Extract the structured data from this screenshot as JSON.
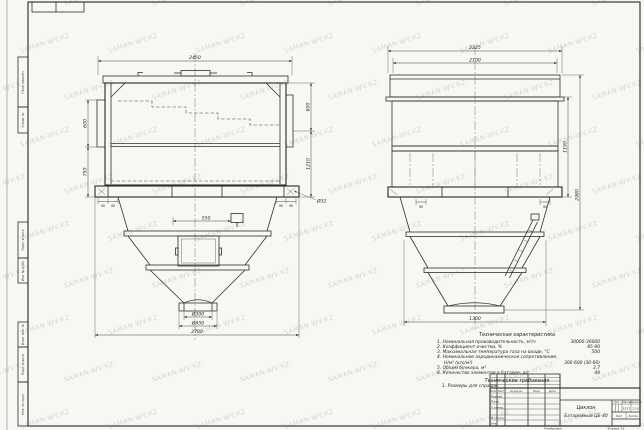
{
  "sheet": {
    "watermark": "SAMAN-WV.KZ"
  },
  "front_view": {
    "dims": {
      "width_top": "2450",
      "left_upper": "600",
      "left_lower": "750",
      "right_upper": "600",
      "right_lower": "1210",
      "inset": "550",
      "foot": "90",
      "hole": "Ø32",
      "outlet_inner": "Ø300",
      "outlet_outer": "Ø450",
      "width_bottom": "2700"
    }
  },
  "side_view": {
    "dims": {
      "width_top": "2225",
      "width_inner": "2100",
      "height_mid": "1190",
      "height_overall": "2980",
      "width_bottom": "1300",
      "foot": "90"
    }
  },
  "specs": {
    "title": "Техническая характеристика",
    "items": [
      {
        "label": "1. Номинальная производительность, м³/ч",
        "value": "30000-36000"
      },
      {
        "label": "2. Коэффициент очистки, %",
        "value": "85-90"
      },
      {
        "label": "3. Максимальная температура газа на входе, °С",
        "value": "500"
      },
      {
        "label": "4. Номинальное аэродинамическое сопротивление,",
        "value": ""
      },
      {
        "label": "Н/м² (кгс/м²)",
        "value": "300-600 (30-60)"
      },
      {
        "label": "5. Объем бункера, м³",
        "value": "3,7"
      },
      {
        "label": "6. Количество элементов в батарее, шт.",
        "value": "48"
      }
    ],
    "req_title": "Технические требования",
    "req_items": [
      "1. Размеры для справок."
    ]
  },
  "title_block": {
    "header_cols": [
      "Изм.",
      "Лист",
      "№ докум.",
      "Подп.",
      "Дата"
    ],
    "row_labels": [
      "Разраб.",
      "Пров.",
      "Т.контр.",
      "Н.контр.",
      "Утв."
    ],
    "name_line1": "Циклон",
    "name_line2": "Батарейный ЦБ-40",
    "lit_label": "Лит.",
    "mass_label": "Масса",
    "scale_label": "Масштаб",
    "mass": "2217",
    "scale": "1:10",
    "sheet_label": "Лист",
    "sheets_label": "Листов",
    "copied": "Копировал",
    "format": "Формат А1"
  },
  "margin": {
    "boxes": [
      "Перв. примен.",
      "Справ. №",
      "Подп. и дата",
      "Инв. № дубл.",
      "Взам. инв. №",
      "Подп. и дата",
      "Инв. № подл."
    ]
  }
}
